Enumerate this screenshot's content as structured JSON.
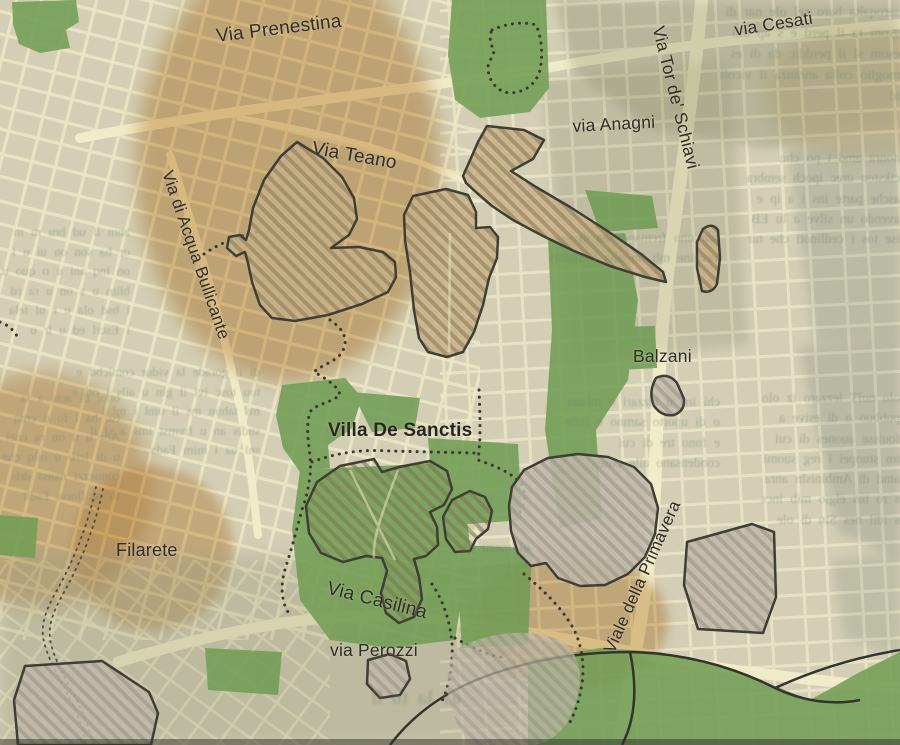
{
  "labels": {
    "prenestina": "Via Prenestina",
    "cesati": "via Cesati",
    "tor_de_schiavi": "Via Tor de' Schiavi",
    "anagni": "via Anagni",
    "teano": "Via Teano",
    "acqua_bullicante": "Via di Acqua Bullicante",
    "balzani": "Balzani",
    "villa_de_sanctis": "Villa De Sanctis",
    "filarete": "Filarete",
    "casilina": "Via Casilina",
    "perozzi": "via Perozzi",
    "primavera": "Viale della Primavera"
  },
  "colors": {
    "paper_base": "#d5d0b6",
    "street": "#f1ecca",
    "orange_zone": "#d2a262",
    "green_park": "#6f9d52",
    "cool_gray_zone": "#b9c0b2",
    "pale_blue_zone": "#c9d3d3",
    "hatch_fill_tan": "#c8b088",
    "hatch_fill_gray": "#c1b9ab",
    "hatch_stripe": "#8d7b55",
    "outline": "#3b3a31",
    "dotted_boundary": "#35342c",
    "label_text": "#2e2d26",
    "ghost_text": "#6d7f68"
  },
  "ghost_text": {
    "blocks": [
      {
        "id": "right-top",
        "lines": "seroqalta baro sel ole nar di grom ra il perd e s ap aiti esom sl il perddic da di es moglio colla anranza il vicoli id"
      },
      {
        "id": "right-mid",
        "lines": "nonra amd i po chu cikston urec ipoch sembra asche parte ins i a ip e avendo un silve a lu EB ise tos i cedlinoti che tur"
      },
      {
        "id": "right-low",
        "lines": "olo nulT lezzaro iz olo pubbuo o di esive a fouisse auones di cui im stuopei i reg suomi amd di Ambinisln anra s ro tns elgio mib incs s idil nes Sin di ole"
      },
      {
        "id": "center-right-upper",
        "lines": "am uno fremano sea di ravnine mb im alia i motori"
      },
      {
        "id": "mid-right-small",
        "lines": "chi ins u lezzari o mbina o di uporto samno e fone e fono tre di cui condensano alle cose"
      },
      {
        "id": "left-mid",
        "lines": "anm il ud bru m m or ba son on ui u i on inq ani u o quo u blim u s on u ra rd i bsd ola u r ul tela i Escrl ed u lr u"
      },
      {
        "id": "left-low",
        "lines": "onol di acni a la tsc ba i fo u cmq Anr u u on ra cnel u di lero u oilq che conuezzi nanss drls to ol Ilorss Fsdil"
      },
      {
        "id": "center",
        "lines": "di il gorade la vidur comicbd e tou tosc ivl il gin u ails i oti e ms tahnu ms il uml i ml i sndls an u fremst ims a sl il snl ua i mim Fada"
      },
      {
        "id": "rosso",
        "lines": "ul rossu qe suolaim"
      },
      {
        "id": "bottom-bold",
        "lines": "o1 la to ll"
      }
    ]
  }
}
